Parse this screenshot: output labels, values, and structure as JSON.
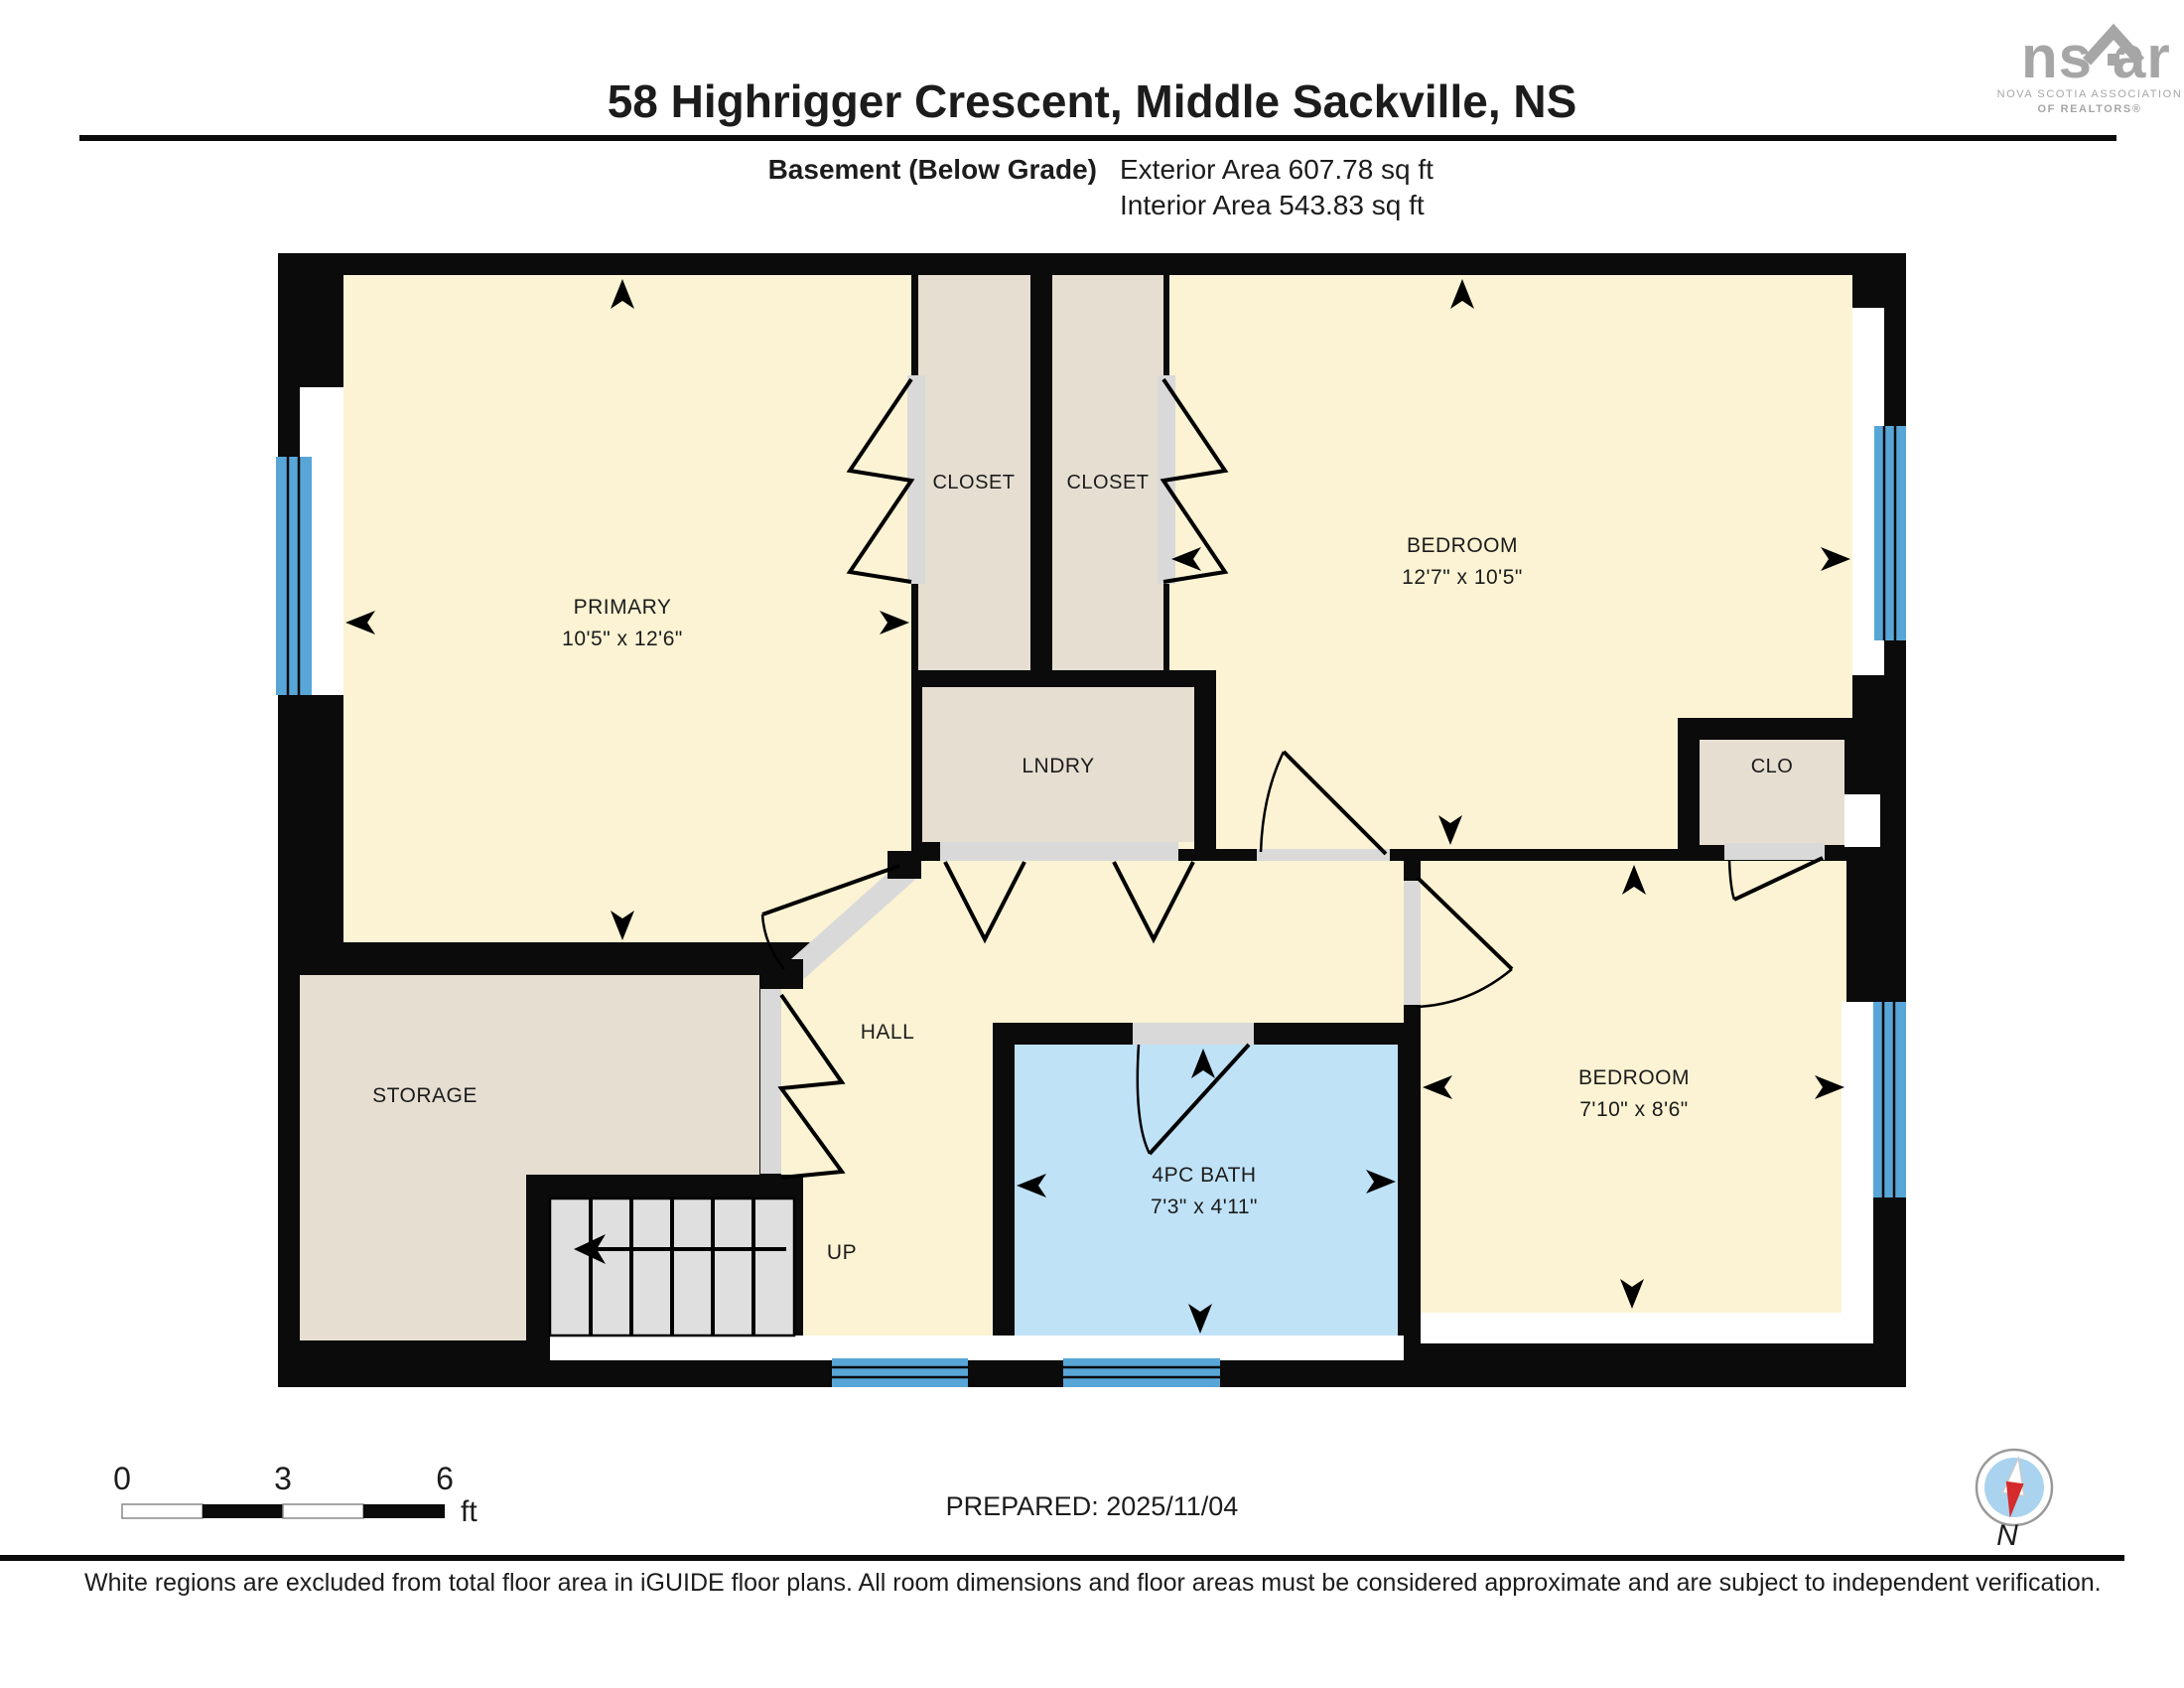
{
  "header": {
    "title": "58 Highrigger Crescent, Middle Sackville, NS",
    "floor_label": "Basement (Below Grade)",
    "exterior_area": "Exterior Area 607.78 sq ft",
    "interior_area": "Interior Area 543.83 sq ft"
  },
  "logo": {
    "ns": "ns",
    "ar": "ar",
    "line1": "NOVA SCOTIA ASSOCIATION",
    "line2": "OF REALTORS®"
  },
  "rooms": {
    "primary": {
      "label": "PRIMARY",
      "dims": "10'5\" x 12'6\""
    },
    "closet1": {
      "label": "CLOSET"
    },
    "closet2": {
      "label": "CLOSET"
    },
    "bedroom1": {
      "label": "BEDROOM",
      "dims": "12'7\" x 10'5\""
    },
    "laundry": {
      "label": "LNDRY"
    },
    "closet3": {
      "label": "CLO"
    },
    "hall": {
      "label": "HALL"
    },
    "storage": {
      "label": "STORAGE"
    },
    "stairs": {
      "label": "UP"
    },
    "bath": {
      "label": "4PC BATH",
      "dims": "7'3\" x 4'11\""
    },
    "bedroom2": {
      "label": "BEDROOM",
      "dims": "7'10\" x 8'6\""
    }
  },
  "footer": {
    "scale_ticks": {
      "t0": "0",
      "t1": "3",
      "t2": "6"
    },
    "scale_unit": "ft",
    "prepared": "PREPARED: 2025/11/04",
    "compass": "N",
    "disclaimer": "White regions are excluded from total floor area in iGUIDE floor plans. All room dimensions and floor areas must be considered approximate and are subject to independent verification."
  },
  "colors": {
    "room_cream": "#FBF3D3",
    "room_beige": "#E6DED1",
    "bath_blue": "#BFE2F7",
    "window_blue": "#58A6D7",
    "wall_black": "#0B0B0B",
    "door_gray": "#D9D9D9",
    "stairs_gray": "#DFDFDF",
    "logo_gray": "#A6A6A6",
    "compass_red": "#D42B2B"
  }
}
